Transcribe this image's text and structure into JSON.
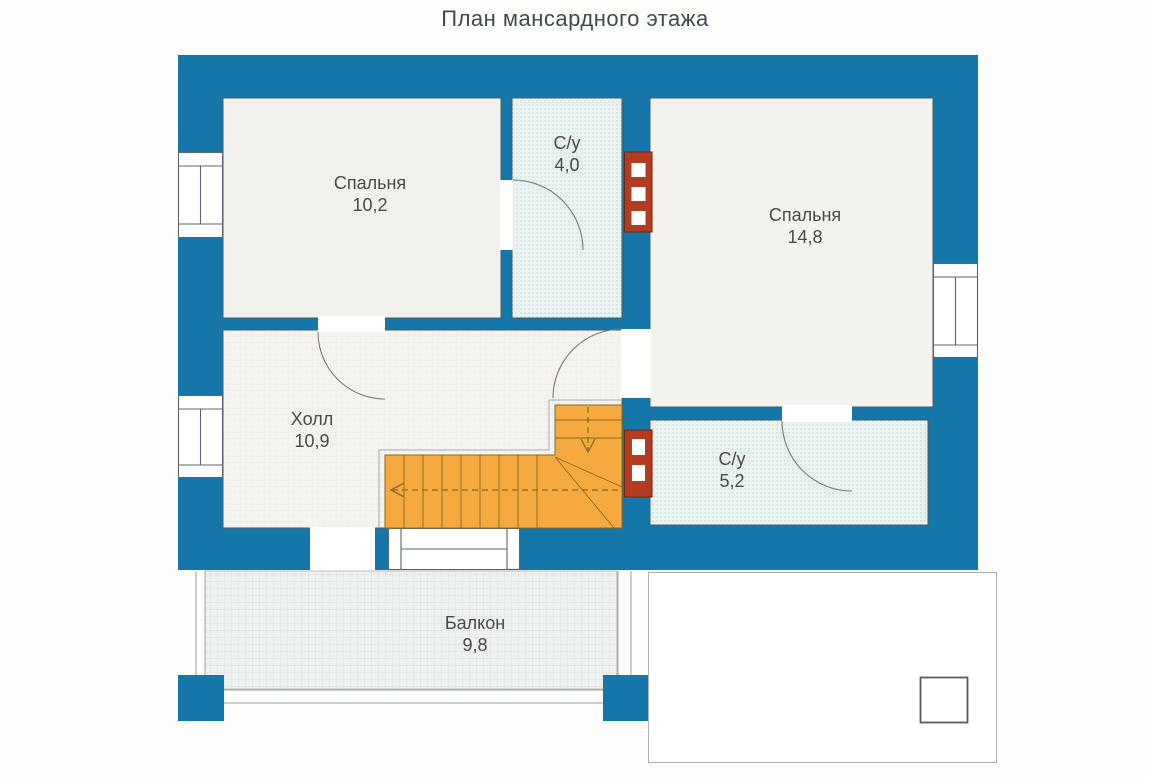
{
  "title": "План мансардного этажа",
  "rooms": {
    "bedroom_small": {
      "name": "Спальня",
      "area": "10,2"
    },
    "wc_small": {
      "name": "С/у",
      "area": "4,0"
    },
    "bedroom_large": {
      "name": "Спальня",
      "area": "14,8"
    },
    "hall": {
      "name": "Холл",
      "area": "10,9"
    },
    "wc_large": {
      "name": "С/у",
      "area": "5,2"
    },
    "balcony": {
      "name": "Балкон",
      "area": "9,8"
    }
  },
  "colors": {
    "wall": "#1577a9",
    "stairs": "#f6a93f",
    "chimney": "#b23b20",
    "bath-fill": "#e9f2ef",
    "room-fill": "#f3f1ed",
    "hall-fill": "#f4f3ef",
    "balcony-fill": "#eef1f0",
    "text": "#4a4a4a"
  }
}
